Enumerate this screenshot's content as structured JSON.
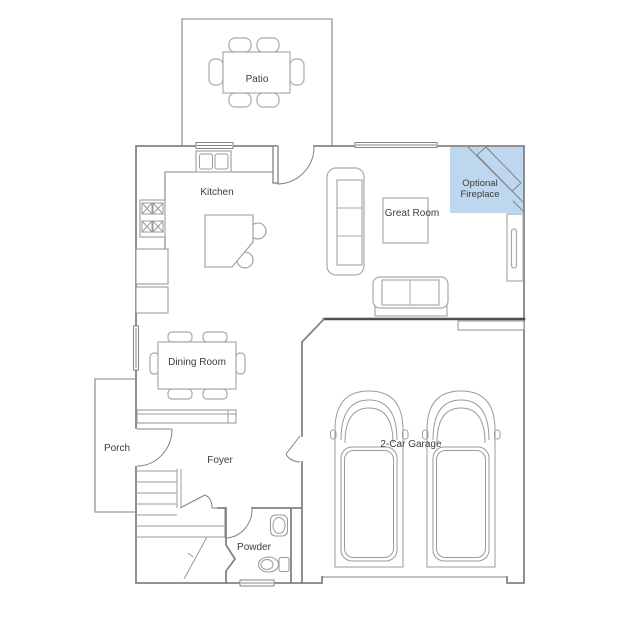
{
  "colors": {
    "background": "#ffffff",
    "wall": "#838383",
    "wall_dark": "#4f4f4f",
    "furniture": "#a9a9a9",
    "fixture": "#9b9b9b",
    "text": "#3c3c3c",
    "fireplace_fill": "#bdd7ee"
  },
  "rooms": {
    "patio": {
      "label": "Patio"
    },
    "kitchen": {
      "label": "Kitchen"
    },
    "great_room": {
      "label": "Great Room"
    },
    "optional_fireplace": {
      "label": "Optional Fireplace",
      "line1": "Optional",
      "line2": "Fireplace"
    },
    "dining_room": {
      "label": "Dining Room"
    },
    "porch": {
      "label": "Porch"
    },
    "foyer": {
      "label": "Foyer"
    },
    "powder": {
      "label": "Powder"
    },
    "garage": {
      "label": "2-Car Garage"
    }
  }
}
